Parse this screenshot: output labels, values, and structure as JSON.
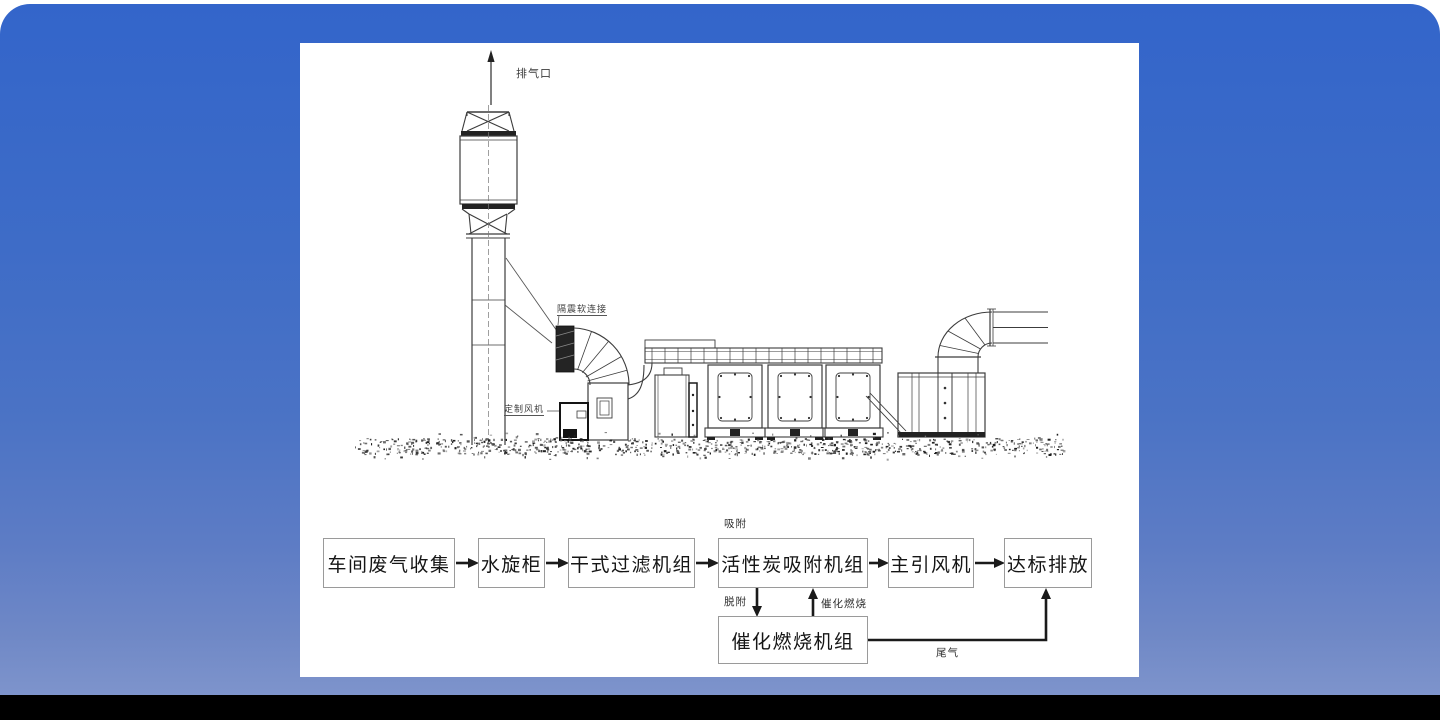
{
  "panel": {
    "schematic_labels": {
      "exhaust_outlet": "排气口",
      "vibration_flex_connection": "隔震软连接",
      "custom_fan": "定制风机"
    },
    "flowchart": {
      "nodes": [
        {
          "key": "workshop-exhaust-collection",
          "label": "车间废气收集"
        },
        {
          "key": "water-spray-cabinet",
          "label": "水旋柜"
        },
        {
          "key": "dry-filter-unit",
          "label": "干式过滤机组"
        },
        {
          "key": "activated-carbon-adsorption-unit",
          "label": "活性炭吸附机组"
        },
        {
          "key": "main-draft-fan",
          "label": "主引风机"
        },
        {
          "key": "compliant-discharge",
          "label": "达标排放"
        },
        {
          "key": "catalytic-combustion-unit",
          "label": "催化燃烧机组"
        }
      ],
      "flow_labels": {
        "adsorption": "吸附",
        "desorption": "脱附",
        "catalytic_combustion": "催化燃烧",
        "tail_gas": "尾气"
      }
    }
  },
  "colors": {
    "background_top": "#3365ca",
    "background_bottom": "#7e94cc",
    "bottom_bar": "#000000",
    "panel": "#ffffff",
    "drawing_line": "#3c3c3c",
    "flow_line": "#1a1a1a",
    "box_border": "#9a9a9a"
  }
}
